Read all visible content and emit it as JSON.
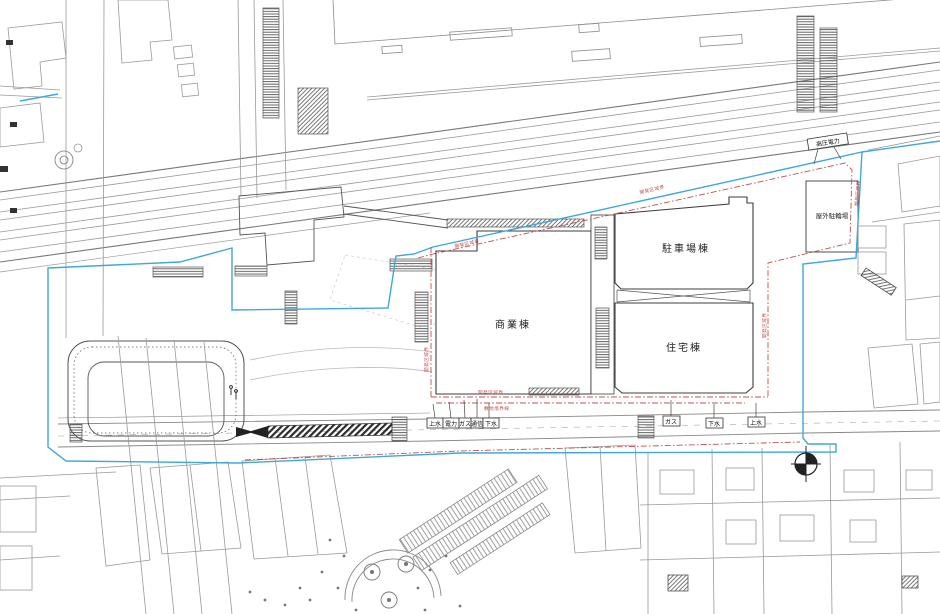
{
  "buildings": {
    "commercial": "商業棟",
    "parking": "駐車場棟",
    "residential": "住宅棟",
    "outdoor_bicycle_parking": "屋外駐輪場"
  },
  "utilities": {
    "cluster": [
      "上水",
      "電力",
      "ガス",
      "通信",
      "下水"
    ],
    "east": [
      "ガス",
      "下水",
      "上水"
    ],
    "high_voltage": "高圧電力"
  },
  "boundaries": {
    "development_area": "開発区域界",
    "site_boundary": "敷地境界線"
  },
  "colors": {
    "boundary_blue": "#3fa8d8",
    "boundary_red": "#c0504d"
  }
}
